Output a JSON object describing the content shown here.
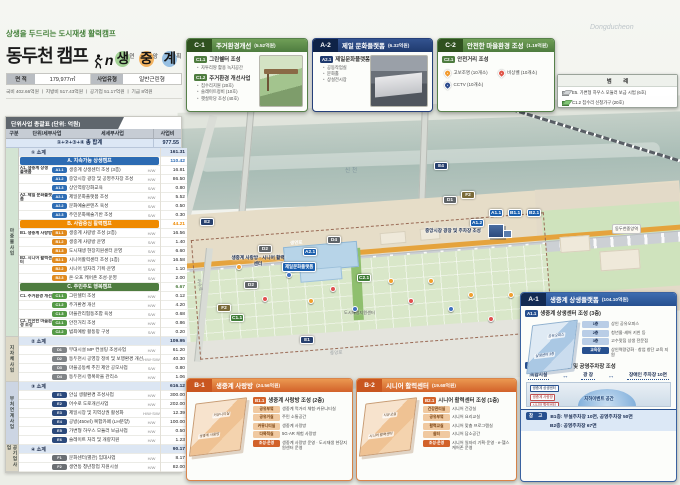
{
  "header": {
    "tagline": "상생을 두드리는 도시재생 활력캠프",
    "title": "동두천 캠프",
    "logo_n": "n",
    "title_chars": [
      {
        "big": "생",
        "small": "연",
        "cstyle": "background:#8fc97e"
      },
      {
        "big": "중",
        "small": "앙",
        "cstyle": "background:#f2a23c"
      },
      {
        "big": "계",
        "small": "획",
        "cstyle": "background:#7fb3e0"
      }
    ],
    "info": {
      "area_label": "면 적",
      "area_value": "179,977㎡",
      "type_label": "사업유형",
      "type_value": "일반근린형"
    },
    "budget_line": "국비 402.66억원 ㅣ 지방비 517.43억원 ㅣ 공기업 51.17억원 ㅣ 기금 8억원"
  },
  "table": {
    "title": "단위사업 총괄표 (단위: 억원)",
    "columns": [
      "구분",
      "단위/세부사업",
      "세세부사업",
      "사업비"
    ],
    "side_groups": [
      {
        "label": "마중물사업",
        "cls": "sg-green",
        "style": "height:189px"
      },
      {
        "label": "지자체사업",
        "cls": "sg-tan",
        "style": "height:45px"
      },
      {
        "label": "부처연계사업",
        "cls": "sg-blue",
        "style": "height:63px"
      },
      {
        "label": "공기업사업",
        "cls": "sg-tan",
        "style": "height:27px"
      }
    ],
    "total": {
      "label": "①+②+③+④ 총 합계",
      "cost": "977.55"
    },
    "rows": [
      {
        "cls": "sub",
        "text": "① 소계",
        "cost": "161.31"
      },
      {
        "cls": "sec sec-a",
        "text": "A. 지속가능 상생캠프",
        "cost": "110.42"
      },
      {
        "cls": "item",
        "group": "A1. 생중계 상생 플랫폼",
        "badge": "A1.1",
        "bcls": "bg-a",
        "text": "생중계 상생센터 조성 (3층)",
        "hw": "H/W",
        "cost": "16.81"
      },
      {
        "cls": "item",
        "badge": "A1.2",
        "bcls": "bg-a",
        "text": "중앙시장 광장 및 공영주차장 조성",
        "hw": "H/W",
        "cost": "86.50"
      },
      {
        "cls": "item",
        "badge": "A1.3",
        "bcls": "bg-a",
        "text": "상인역량강화교육",
        "hw": "S/W",
        "cost": "0.80"
      },
      {
        "cls": "item",
        "group": "A2. 제일 문화플랫폼",
        "badge": "A2.1",
        "bcls": "bg-a",
        "text": "제일문화플랫폼 조성",
        "hw": "H/W",
        "cost": "5.52"
      },
      {
        "cls": "item",
        "badge": "A2.2",
        "bcls": "bg-a",
        "text": "문화예술콘텐츠 육성",
        "hw": "S/W",
        "cost": "0.50"
      },
      {
        "cls": "item",
        "badge": "A2.3",
        "bcls": "bg-a",
        "text": "주민문화예술기반 조성",
        "hw": "S/W",
        "cost": "0.30"
      },
      {
        "cls": "sec sec-b",
        "text": "B. 사람중심 활력캠프",
        "cost": "44.21"
      },
      {
        "cls": "item",
        "group": "B1. 생중계 사랑방",
        "badge": "B1.1",
        "bcls": "bg-b",
        "text": "생중계 사랑방 조성 (2층)",
        "hw": "H/W",
        "cost": "16.56"
      },
      {
        "cls": "item",
        "badge": "B1.2",
        "bcls": "bg-b",
        "text": "생중계 사랑방 운영",
        "hw": "S/W",
        "cost": "1.40"
      },
      {
        "cls": "item",
        "badge": "B1.3",
        "bcls": "bg-b",
        "text": "도시재생 현장지원센터 운영",
        "hw": "S/W",
        "cost": "6.60"
      },
      {
        "cls": "item",
        "group": "B2. 시니어 활력센터",
        "badge": "B2.1",
        "bcls": "bg-b",
        "text": "시니어활력센터 조성 (1층)",
        "hw": "H/W",
        "cost": "16.58"
      },
      {
        "cls": "item",
        "badge": "B2.2",
        "bcls": "bg-b",
        "text": "시니어 일자리 기획·운영",
        "hw": "S/W",
        "cost": "1.10"
      },
      {
        "cls": "item",
        "badge": "B2.3",
        "bcls": "bg-b",
        "text": "온·오프 케어존 조성·운영",
        "hw": "S/W",
        "cost": "2.00"
      },
      {
        "cls": "sec sec-c",
        "text": "C. 주민주도 행복캠프",
        "cost": "6.67"
      },
      {
        "cls": "item",
        "group": "C1. 주거환경 개선",
        "badge": "C1.1",
        "bcls": "bg-c",
        "text": "그린쉘터 조성",
        "hw": "H/W",
        "cost": "0.12"
      },
      {
        "cls": "item",
        "badge": "C1.2",
        "bcls": "bg-c",
        "text": "주거환경 개선",
        "hw": "H/W",
        "cost": "4.20"
      },
      {
        "cls": "item",
        "badge": "C1.3",
        "bcls": "bg-c",
        "text": "마을관리협동조합 육성",
        "hw": "S/W",
        "cost": "0.68"
      },
      {
        "cls": "item",
        "group": "C2. 안전한 마을환경 조성",
        "badge": "C2.1",
        "bcls": "bg-c",
        "text": "안전거리 조성",
        "hw": "H/W",
        "cost": "0.86"
      },
      {
        "cls": "item",
        "badge": "C2.2",
        "bcls": "bg-c",
        "text": "범죄예방 활동망 구성",
        "hw": "S/W",
        "cost": "0.20"
      },
      {
        "cls": "sub",
        "text": "② 소계",
        "cost": "109.95"
      },
      {
        "cls": "item",
        "badge": "D1",
        "bcls": "bg-d",
        "text": "부대시설 MP 컨설팅 조성사업",
        "hw": "H/W",
        "cost": "61.20"
      },
      {
        "cls": "item",
        "badge": "D2",
        "bcls": "bg-d",
        "text": "동두천시 공영장 정비 및 보행환경 개선",
        "hw": "H/W·S/W",
        "cost": "40.30"
      },
      {
        "cls": "item",
        "badge": "D3",
        "bcls": "bg-d",
        "text": "마을공동체 추진 제안 공모사업",
        "hw": "S/W",
        "cost": "0.80"
      },
      {
        "cls": "item",
        "badge": "D4",
        "bcls": "bg-d",
        "text": "동두천시 행복마을 관리소",
        "hw": "H/W",
        "cost": "1.06"
      },
      {
        "cls": "sub",
        "text": "③ 소계",
        "cost": "616.12"
      },
      {
        "cls": "item",
        "badge": "E1",
        "bcls": "bg-e",
        "text": "안심 생활환경 조성사업",
        "hw": "H/W",
        "cost": "300.00"
      },
      {
        "cls": "item",
        "badge": "E2",
        "bcls": "bg-e",
        "text": "어수로 도로개선사업",
        "hw": "H/W",
        "cost": "202.00"
      },
      {
        "cls": "item",
        "badge": "E3",
        "bcls": "bg-e",
        "text": "제일시장 및 지역상권 활성화",
        "hw": "H/W·S/W",
        "cost": "12.39"
      },
      {
        "cls": "item",
        "badge": "E4",
        "bcls": "bg-e",
        "text": "공방(450㎡) 복합카페 (LH분양)",
        "hw": "H/W",
        "cost": "100.00"
      },
      {
        "cls": "item",
        "badge": "E5",
        "bcls": "bg-e",
        "text": "가변형 하우스 모듈러 보급사업",
        "hw": "H/W",
        "cost": "0.50"
      },
      {
        "cls": "item",
        "badge": "E6",
        "bcls": "bg-e",
        "text": "슬레이트 처리 및 개량지원",
        "hw": "H/W",
        "cost": "1.23"
      },
      {
        "cls": "sub",
        "text": "④ 소계",
        "cost": "90.17"
      },
      {
        "cls": "item",
        "badge": "F1",
        "bcls": "bg-f",
        "text": "문화센터(별관) 임대사업",
        "hw": "H/W",
        "cost": "8.17"
      },
      {
        "cls": "item",
        "badge": "F2",
        "bcls": "bg-f",
        "text": "생연동 청년창업 지원시설",
        "hw": "H/W",
        "cost": "82.00"
      }
    ]
  },
  "c1": {
    "code": "C-1",
    "title": "주거환경개선",
    "amount": "(5.52억원)",
    "s1_badge": "C1.1",
    "s1_title": "그린쉘터 조성",
    "s1_bullets": [
      {
        "t": "자투리땅 활용 녹지공간"
      }
    ],
    "s2_badge": "C1.2",
    "s2_title": "주거환경 개선사업",
    "s2_bullets": [
      {
        "t": "집수리지원 (20호)"
      },
      {
        "t": "슬레이트정비 (10호)"
      },
      {
        "t": "햇살마당 조성 (40호)"
      }
    ]
  },
  "a2": {
    "code": "A-2",
    "title": "제일 문화플랫폼",
    "amount": "(6.32억원)",
    "s1_badge": "A2.1",
    "s1_title": "제일문화플랫폼 조성",
    "bullets": [
      {
        "t": "공동작업실"
      },
      {
        "t": "문화홀"
      },
      {
        "t": "상설전시장"
      }
    ]
  },
  "c2": {
    "code": "C-2",
    "title": "안전한 마을환경 조성",
    "amount": "(1.19억원)",
    "s1_badge": "C2.1",
    "s1_title": "안전거리 조성",
    "pins": [
      {
        "label": "고보조명 (10개소)",
        "pstyle": "background:#f29a2e"
      },
      {
        "label": "비상벨 (10개소)",
        "pstyle": "background:#e05548"
      },
      {
        "label": "CCTV (10개소)",
        "pstyle": "background:#2c4a8c"
      }
    ]
  },
  "legend": {
    "title": "범 례",
    "items": [
      {
        "cube": "cube-gray",
        "label": "E5. 가변형 하우스 모듈러 보급 시범 (6호)"
      },
      {
        "cube": "cube-green",
        "label": "C1.2 집수리 신청가구 (20호)"
      }
    ]
  },
  "b1": {
    "code": "B-1",
    "title": "생중계 사랑방",
    "amount": "(24.56억원)",
    "s1_badge": "B1.1",
    "s1_title": "생중계 사랑방 조성 (2층)",
    "plan_labels": [
      "생중계 사랑방",
      "커뮤니티실"
    ],
    "rows": [
      {
        "b": "공유부엌",
        "t": "생중계 먹거리 체험·커뮤니티실"
      },
      {
        "b": "공유거실",
        "t": "주민 소통공간"
      },
      {
        "b": "커뮤니티실",
        "t": "생중계 사랑방"
      },
      {
        "b": "다목적실",
        "t": "5G·AR 체험 사랑방"
      },
      {
        "b": "조성·운영",
        "bc": "rb-dark",
        "t": "생중계 사랑방 운영 · 도시재생 현장지원센터 운영"
      }
    ]
  },
  "b2": {
    "code": "B-2",
    "title": "시니어 활력센터",
    "amount": "(19.68억원)",
    "s1_badge": "B2.1",
    "s1_title": "시니어 활력센터 조성 (1층)",
    "plan_labels": [
      "시니어 활력센터",
      "치유교실"
    ],
    "rows": [
      {
        "b": "건강관리실",
        "t": "시니어 건강실"
      },
      {
        "b": "공유부엌",
        "t": "시니어 요리교실"
      },
      {
        "b": "활력교실",
        "t": "시니어 맞춤 프로그램실"
      },
      {
        "b": "쉼터",
        "t": "시니어 담소공간"
      },
      {
        "b": "조성·운영",
        "bc": "rb-dark",
        "t": "시니어 일자리 기획·운영 · e-헬스케어존 운영"
      }
    ]
  },
  "a1": {
    "code": "A-1",
    "title": "생중계 상생플랫폼",
    "amount": "(104.10억원)",
    "s1_badge": "A1.1",
    "s1_title": "생중계 상생센터 조성 (3층)",
    "plan_labels": [
      "상생센터 3층",
      "공유오피스"
    ],
    "rows": [
      {
        "b": "1층",
        "bc": "rb-n",
        "t": "상인 공유오피스"
      },
      {
        "b": "2층",
        "bc": "rb-n",
        "t": "청년몰·셰어 키친 등"
      },
      {
        "b": "3층",
        "bc": "rb-n",
        "t": "고수맛집 상생 전문점"
      },
      {
        "b": "교육장",
        "bc": "rb-navy-dark",
        "t": "상인역량강화 · 창업 창단 교육 지원"
      }
    ],
    "s2_badge": "A1.2",
    "s2_title": "중앙시장 광장 및 공영주차장 조성",
    "strip": [
      "복합시설",
      "광 장",
      "장애인 주차장 10면"
    ],
    "dome_label": "지하이벤트 공간",
    "chips": [
      {
        "t": "생중계 상생센터",
        "cc": "rchip-n"
      },
      {
        "t": "생중계 사랑방",
        "cc": ""
      },
      {
        "t": "시니어 활력센터",
        "cc": ""
      }
    ],
    "note_badge": "참 고",
    "note_line1": "B1층: 부설주차장 10면, 공영주차장 50면",
    "note_line2": "B2층: 공영주차장 67면"
  },
  "map": {
    "markers": [
      {
        "label": "E2",
        "cls": "mk-navy",
        "style": "left:200px;top:218px"
      },
      {
        "label": "E4",
        "cls": "mk-navy",
        "style": "left:434px;top:162px"
      },
      {
        "label": "D1",
        "cls": "mk-gray",
        "style": "left:443px;top:196px"
      },
      {
        "label": "F2",
        "cls": "mk-olive",
        "style": "left:461px;top:191px"
      },
      {
        "label": "D4",
        "cls": "mk-gray",
        "style": "left:327px;top:236px"
      },
      {
        "label": "D2",
        "cls": "mk-gray",
        "style": "left:258px;top:245px"
      },
      {
        "label": "A2.1",
        "cls": "mk-blue",
        "style": "left:303px;top:248px"
      },
      {
        "label": "D2",
        "cls": "mk-gray",
        "style": "left:244px;top:281px"
      },
      {
        "label": "C2.1",
        "cls": "mk-green",
        "style": "left:357px;top:274px"
      },
      {
        "label": "F2",
        "cls": "mk-olive",
        "style": "left:217px;top:304px"
      },
      {
        "label": "C1.1",
        "cls": "mk-green",
        "style": "left:230px;top:314px"
      },
      {
        "label": "E1",
        "cls": "mk-navy",
        "style": "left:300px;top:336px"
      },
      {
        "label": "A1.2",
        "cls": "mk-blue",
        "style": "left:470px;top:219px"
      },
      {
        "label": "A1.1",
        "cls": "mk-blue",
        "style": "left:489px;top:209px"
      },
      {
        "label": "B1.1",
        "cls": "mk-blue",
        "style": "left:508px;top:209px"
      },
      {
        "label": "B2.1",
        "cls": "mk-blue",
        "style": "left:527px;top:209px"
      }
    ],
    "pins": [
      {
        "cls": "pin-o",
        "style": "left:236px;top:264px"
      },
      {
        "cls": "pin-r",
        "style": "left:262px;top:296px"
      },
      {
        "cls": "pin-b",
        "style": "left:286px;top:272px"
      },
      {
        "cls": "pin-o",
        "style": "left:308px;top:298px"
      },
      {
        "cls": "pin-r",
        "style": "left:330px;top:286px"
      },
      {
        "cls": "pin-b",
        "style": "left:352px;top:306px"
      },
      {
        "cls": "pin-o",
        "style": "left:388px;top:278px"
      },
      {
        "cls": "pin-r",
        "style": "left:408px;top:298px"
      },
      {
        "cls": "pin-o",
        "style": "left:428px;top:278px"
      },
      {
        "cls": "pin-b",
        "style": "left:448px;top:306px"
      },
      {
        "cls": "pin-o",
        "style": "left:468px;top:292px"
      },
      {
        "cls": "pin-r",
        "style": "left:488px;top:316px"
      },
      {
        "cls": "pin-o",
        "style": "left:508px;top:292px"
      }
    ],
    "labels": [
      {
        "text": "신천",
        "cls": "lb-river",
        "style": "left:345px;top:166px"
      },
      {
        "text": "Dongducheon",
        "cls": "lb-wm",
        "style": "left:590px;top:24px"
      },
      {
        "text": "생연로",
        "cls": "lb-road",
        "style": "left:290px;top:240px"
      },
      {
        "text": "어수로",
        "cls": "lb-road-v",
        "style": "left:193px;top:282px"
      },
      {
        "text": "중앙로",
        "cls": "lb-road2",
        "style": "left:330px;top:350px"
      },
      {
        "text": "제일문화플랫폼",
        "cls": "lb-chip-blue",
        "style": "left:282px;top:262px"
      },
      {
        "text": "중앙시장 광장 및 주차장 조성",
        "cls": "lb-callout",
        "style": "left:424px;top:228px;width:58px"
      },
      {
        "text": "생중계 사랑방 · 시니어 활력센터",
        "cls": "lb-callout",
        "style": "left:230px;top:255px;width:56px"
      },
      {
        "text": "도시재생지원센터",
        "cls": "lb-small",
        "style": "left:344px;top:310px"
      },
      {
        "text": "동두천중앙역",
        "cls": "lb-chip-white",
        "style": "left:612px;top:224px"
      }
    ]
  }
}
